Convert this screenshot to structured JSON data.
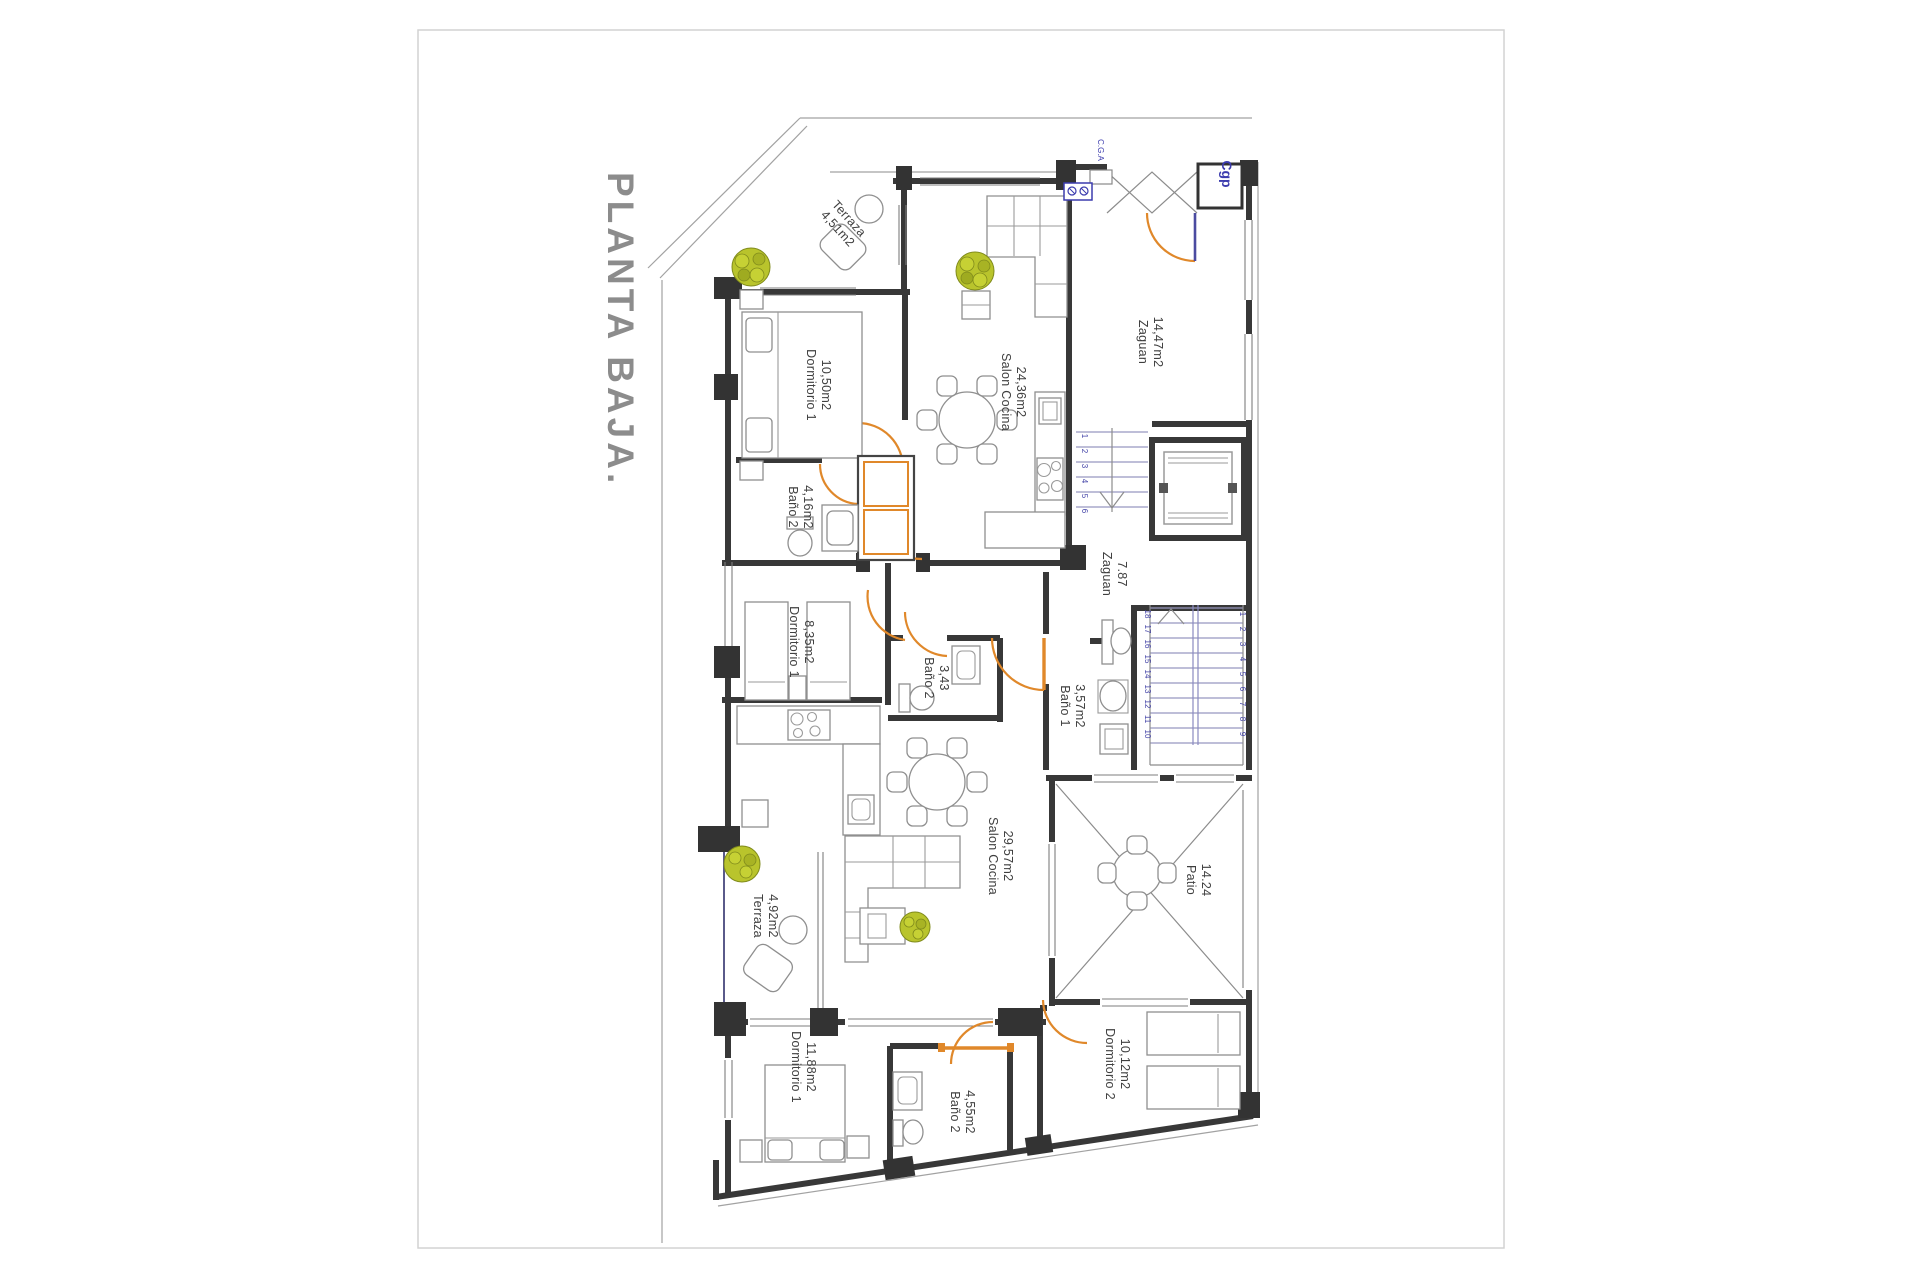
{
  "sheet": {
    "title": "PLANTA BAJA."
  },
  "colors": {
    "wall": "#383838",
    "door_arc": "#e0882a",
    "annotation_blue": "#3c3cae",
    "plant": "#b9c42c",
    "title_gray": "#8c8c8c"
  },
  "rooms": [
    {
      "name": "Terraza",
      "area": "4,51m2"
    },
    {
      "name": "Dormitorio 1",
      "area": "10,50m2"
    },
    {
      "name": "Salon Cocina",
      "area": "24,36m2"
    },
    {
      "name": "Zaguan",
      "area": "14,47m2"
    },
    {
      "name": "Baño 2",
      "area": "4,16m2"
    },
    {
      "name": "Dormitorio 1",
      "area": "8,35m2"
    },
    {
      "name": "Baño 2",
      "area": "3,43"
    },
    {
      "name": "Zaguan",
      "area": "7.87"
    },
    {
      "name": "Baño 1",
      "area": "3,57m2"
    },
    {
      "name": "Salon Cocina",
      "area": "29,57m2"
    },
    {
      "name": "Terraza",
      "area": "4,92m2"
    },
    {
      "name": "Patio",
      "area": "14.24"
    },
    {
      "name": "Dormitorio 1",
      "area": "11,88m2"
    },
    {
      "name": "Baño 2",
      "area": "4,55m2"
    },
    {
      "name": "Dormitorio 2",
      "area": "10,12m2"
    }
  ],
  "tech": {
    "cgp": "Cgp",
    "cga": "C.G.A"
  },
  "stairs": {
    "upper": [
      "1",
      "2",
      "3",
      "4",
      "5",
      "6"
    ],
    "lower_left": [
      "18",
      "17",
      "16",
      "15",
      "14",
      "13",
      "12",
      "11",
      "10"
    ],
    "lower_right": [
      "1",
      "2",
      "3",
      "4",
      "5",
      "6",
      "7",
      "8",
      "9"
    ]
  }
}
